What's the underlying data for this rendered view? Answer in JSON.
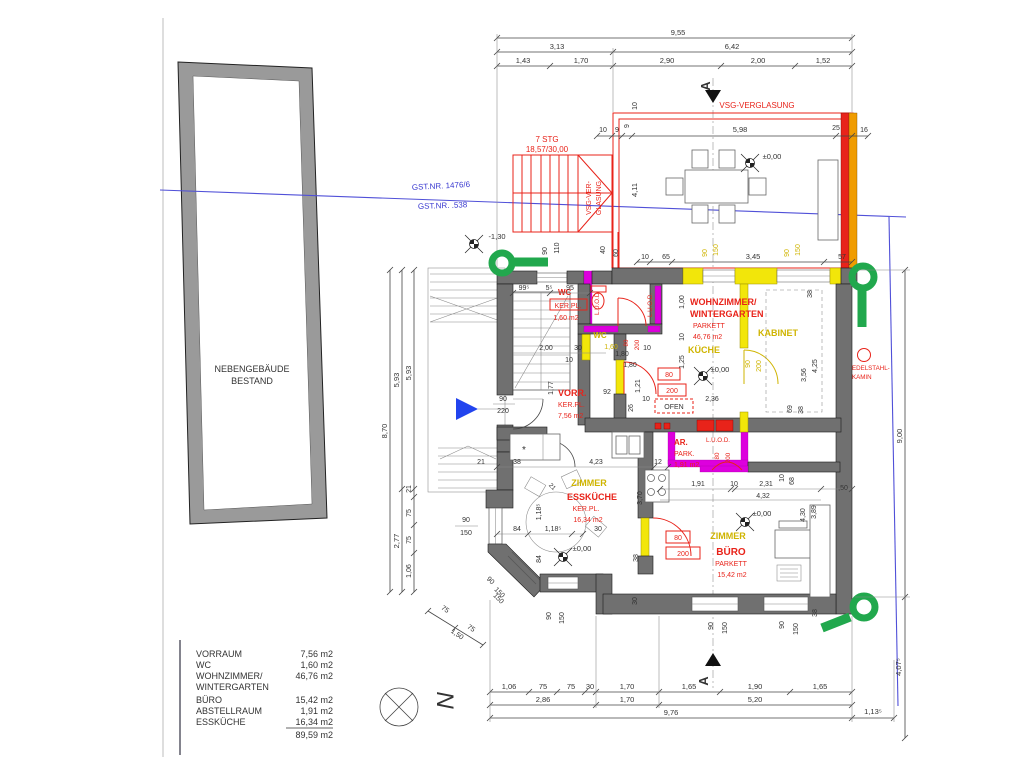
{
  "labels": {
    "outbuilding1": "NEBENGEBÄUDE",
    "outbuilding2": "BESTAND",
    "gst1": "GST.NR. 1476/6",
    "gst2": "GST.NR. .538",
    "stair1": "7 STG",
    "stair2": "18,57/30,00",
    "vsg_top": "VSG-VERGLASUNG",
    "vsg_side1": "VSG-VER-",
    "vsg_side2": "GLASUNG",
    "kamin1": "EDELSTAHL-",
    "kamin2": "KAMIN",
    "ofen": "OFEN",
    "luod": "L.U.O.D.",
    "star": "*",
    "north": "N",
    "section": "A",
    "lvl_zero": "±0,00",
    "lvl_minus": "-1,30"
  },
  "rooms": {
    "wc": {
      "n": "WC",
      "f": "KER.PL.",
      "a": "1,60 m2"
    },
    "wc_y": {
      "n": "WC",
      "a": "1,60"
    },
    "vorr": {
      "n": "VORR.",
      "f": "KER.PL.",
      "a": "7,56 m2"
    },
    "wz": {
      "n1": "WOHNZIMMER/",
      "n2": "WINTERGARTEN",
      "f": "PARKETT",
      "a": "46,76 m2"
    },
    "kabinet": {
      "n": "KABINET"
    },
    "kueche": {
      "n": "KÜCHE"
    },
    "ar": {
      "n": "AR.",
      "f": "PARK.",
      "a": "1,91 m2"
    },
    "essk": {
      "n1": "ZIMMER",
      "n2": "ESSKÜCHE",
      "f": "KER.PL.",
      "a": "16,34 m2"
    },
    "buero": {
      "n1": "ZIMMER",
      "n2": "BÜRO",
      "f": "PARKETT",
      "a": "15,42 m2"
    }
  },
  "dims": {
    "k955": "9,55",
    "k313": "3,13",
    "k642": "6,42",
    "k143": "1,43",
    "k170": "1,70",
    "k290": "2,90",
    "k200": "2,00",
    "k152": "1,52",
    "k10": "10",
    "k9": "9",
    "k598": "5,98",
    "k25": "25",
    "k16": "16",
    "k411": "4,11",
    "k65": "65",
    "k345": "3,45",
    "k57": "57",
    "k90": "90",
    "k150": "150",
    "k40": "40",
    "k60": "60",
    "k110": "110",
    "k870": "8,70",
    "k593": "5,93",
    "k277": "2,77",
    "k21": "21",
    "k75": "75",
    "k106": "1,06",
    "k900": "9,00",
    "k4075": "4,07⁵",
    "k286": "2,86",
    "k165": "1,65",
    "k190": "1,90",
    "k30": "30",
    "k520": "5,20",
    "k976": "9,76",
    "k1135": "1,13⁵",
    "k995": "99⁵",
    "k55": "5⁵",
    "k95": "95",
    "k180": "1,80",
    "k92": "92",
    "k121": "1,21",
    "k26": "26",
    "k177": "1,77",
    "k160": "1,60",
    "k100": "1,00",
    "k125": "1,25",
    "k236": "2,36",
    "k423": "4,23",
    "k12": "12",
    "k370": "3,70",
    "k191": "1,91",
    "k231": "2,31",
    "k432": "4,32",
    "k68": "68",
    "k50": ",50",
    "k430": "4,30",
    "k389": "3,89",
    "k38": "38",
    "k69": "69",
    "k425": "4,25",
    "k356": "3,56",
    "k84": "84",
    "k1185": "1,18⁵",
    "k150b": "1,50",
    "k220": "220",
    "k80": "80",
    "k200b": "200"
  },
  "legend": {
    "rows": [
      {
        "label": "VORRAUM",
        "value": "7,56 m2"
      },
      {
        "label": "WC",
        "value": "1,60 m2"
      },
      {
        "label": "WOHNZIMMER/",
        "value": "46,76 m2"
      },
      {
        "label": "WINTERGARTEN",
        "value": ""
      },
      {
        "label": "BÜRO",
        "value": "15,42 m2"
      },
      {
        "label": "ABSTELLRAUM",
        "value": "1,91 m2"
      },
      {
        "label": "ESSKÜCHE",
        "value": "16,34 m2"
      },
      {
        "label": "",
        "value": "89,59 m2"
      }
    ]
  },
  "colors": {
    "red": "#e8231a",
    "yellow": "#f2e60a",
    "magenta": "#dd00dd",
    "green": "#21a84d",
    "blue": "#5050d8",
    "orange": "#f09c00",
    "wall": "#707070"
  }
}
